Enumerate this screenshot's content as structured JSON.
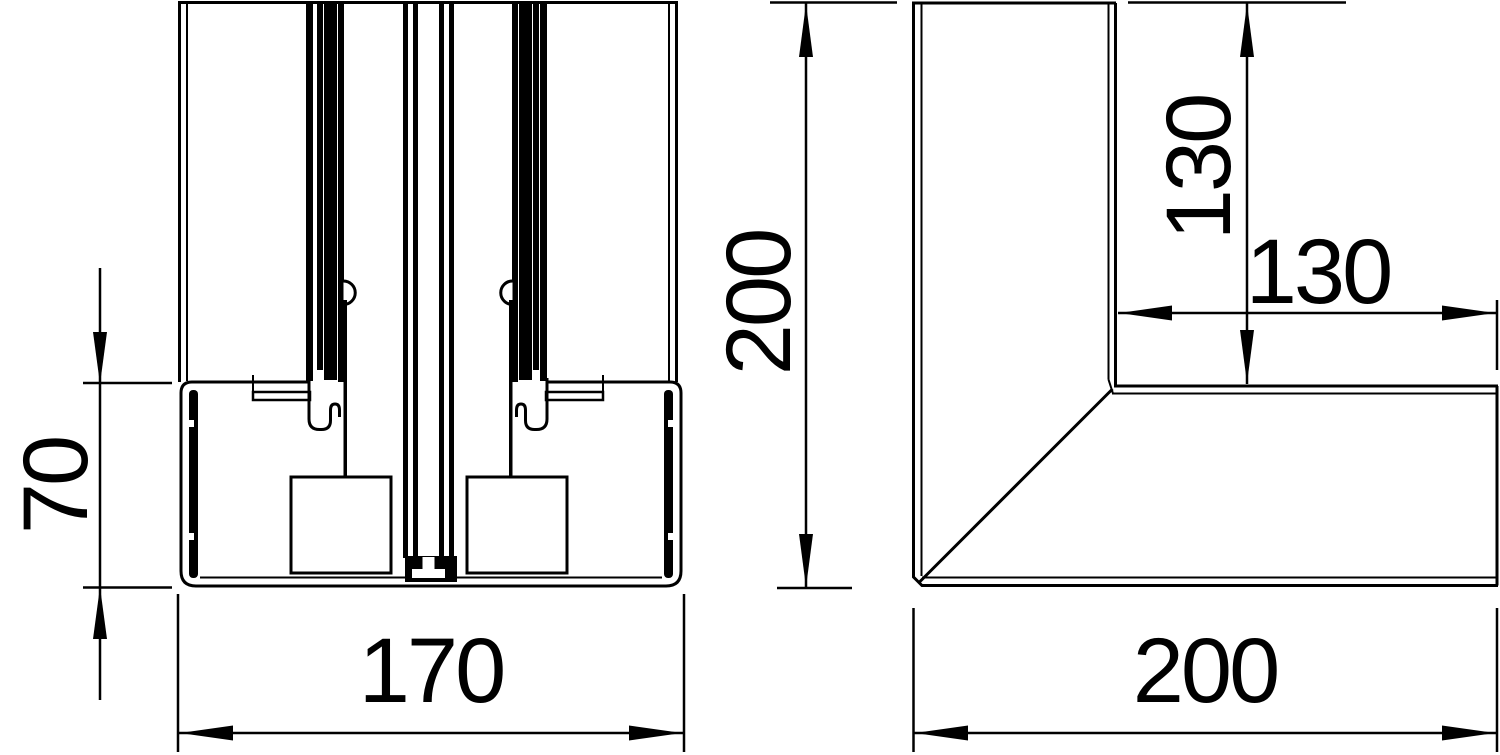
{
  "drawing": {
    "title": "Trunking internal corner technical drawing",
    "background": "#ffffff",
    "line_color": "#000000",
    "views": [
      {
        "id": "cross-section",
        "name": "profile cross-section view",
        "dims": {
          "height": "70",
          "width": "170"
        }
      },
      {
        "id": "corner-plan",
        "name": "internal corner plan view",
        "dims": {
          "outer_height": "200",
          "inner_height": "130",
          "inner_width": "130",
          "outer_width": "200"
        }
      }
    ]
  }
}
